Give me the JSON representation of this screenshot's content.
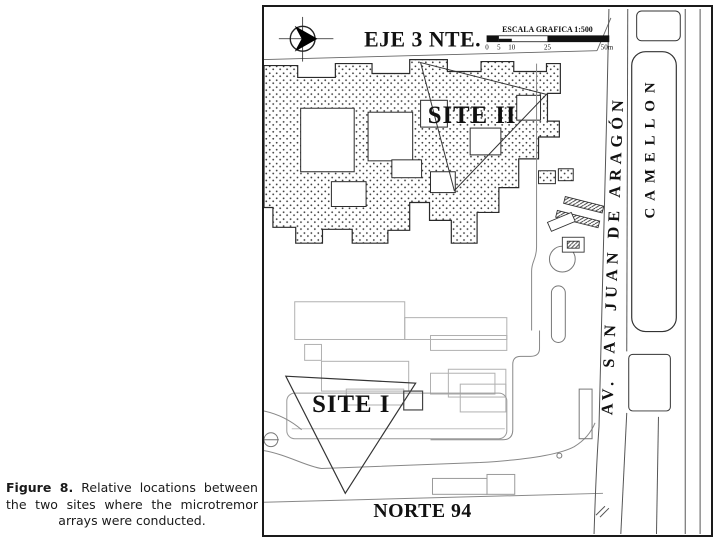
{
  "figure_caption": {
    "label": "Figure 8.",
    "text": "Relative locations between the two sites where the microtremor arrays were conducted."
  },
  "map": {
    "street_top": "EJE 3 NTE.",
    "street_bottom": "NORTE 94",
    "avenue": "AV. SAN JUAN DE ARAGÓN",
    "median_label": "CAMELLON",
    "site1": "SITE I",
    "site2": "SITE II",
    "scale": {
      "title": "ESCALA GRAFICA 1:500",
      "ticks": [
        "0",
        "5",
        "10",
        "25",
        "50m"
      ]
    },
    "icons": {
      "north_arrow": "north-arrow",
      "benchmark": "benchmark-circle"
    },
    "colors": {
      "ink": "#111111",
      "faint_outline": "#b0b0b0",
      "street_line": "#777777"
    }
  }
}
